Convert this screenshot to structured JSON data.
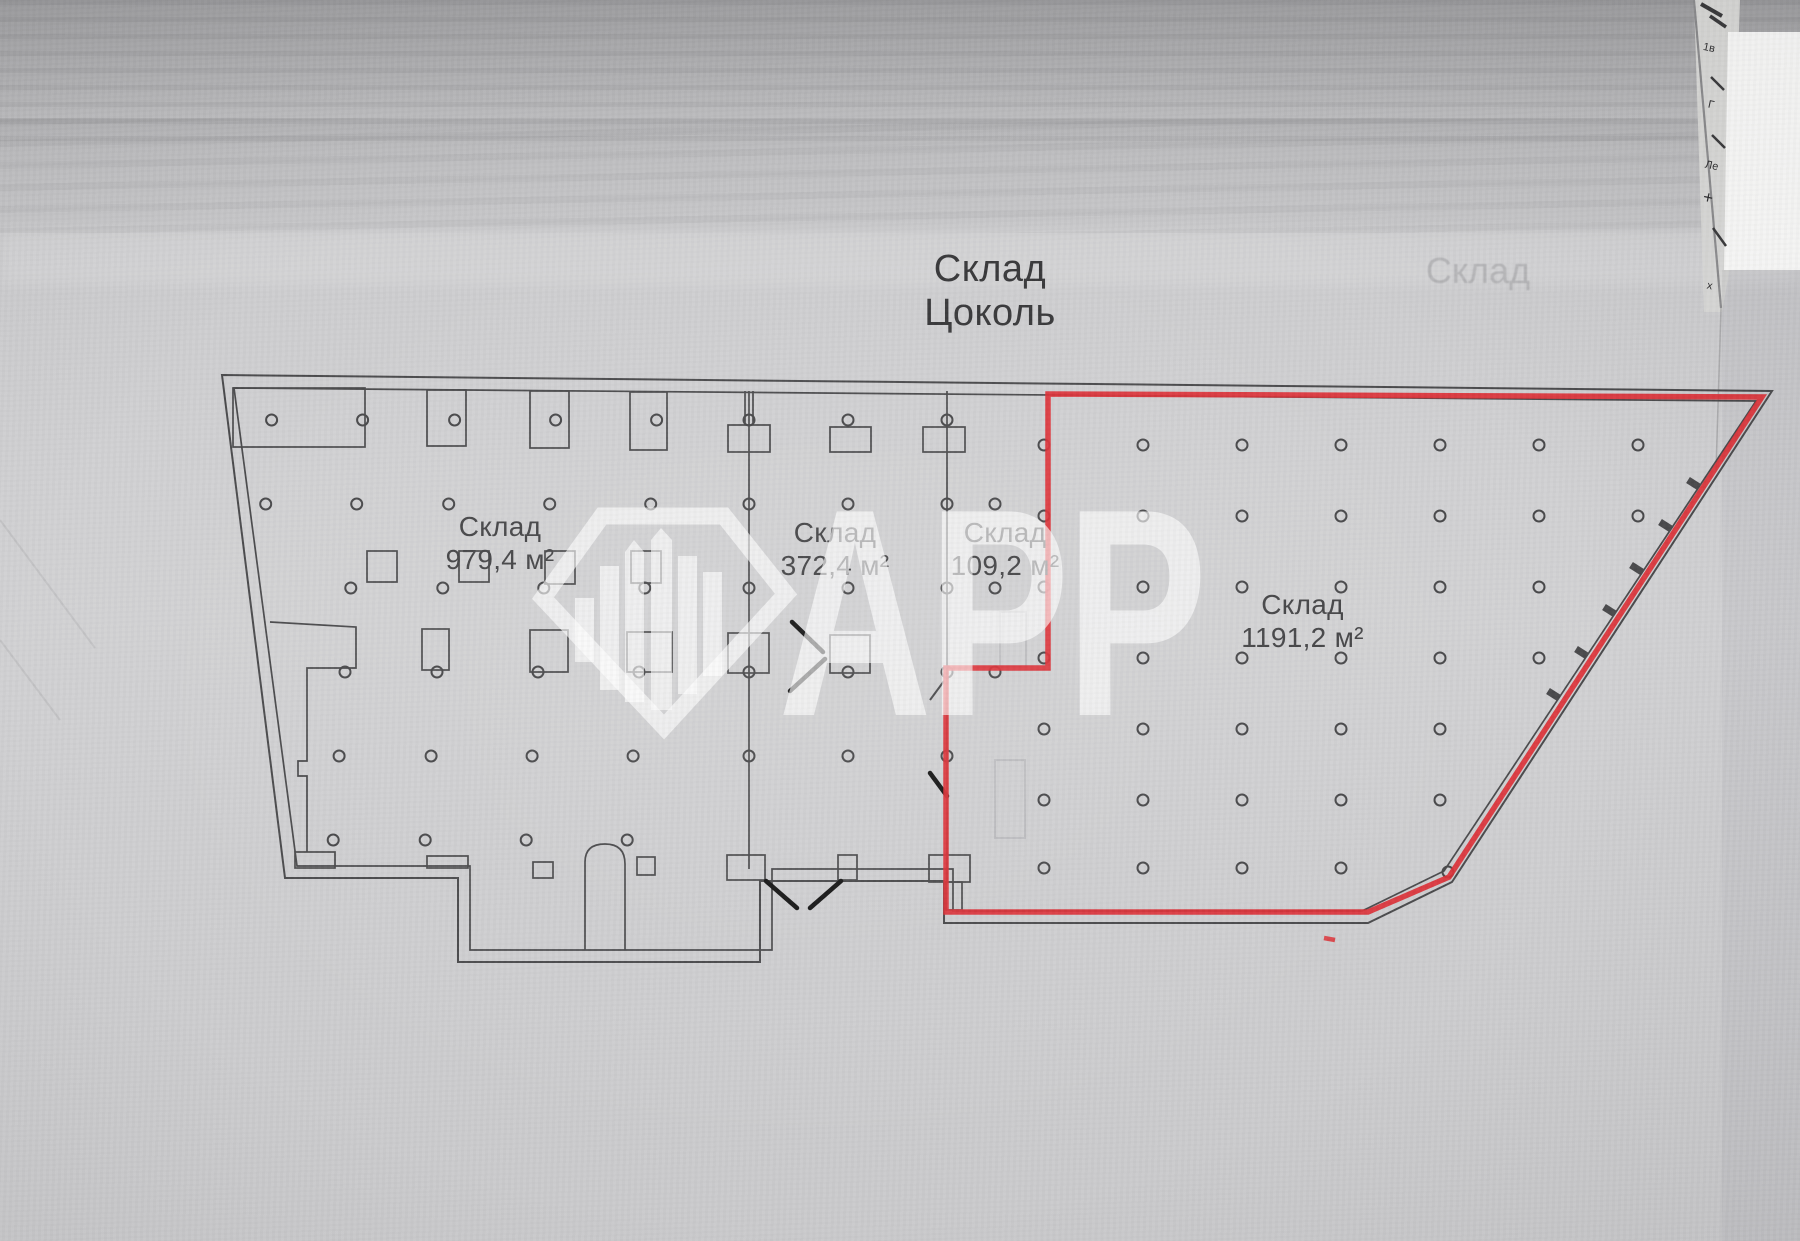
{
  "title": {
    "line1": "Склад",
    "line2": "Цоколь"
  },
  "rooms": [
    {
      "name": "Склад",
      "area": "979,4 м²"
    },
    {
      "name": "Склад",
      "area": "372,4 м²"
    },
    {
      "name": "Склад",
      "area": "109,2 м²"
    },
    {
      "name": "Склад",
      "area": "1191,2 м²"
    }
  ],
  "watermark": {
    "text": "АРР",
    "logo": "diamond-skyline-logo"
  },
  "ghost_text": "Склад",
  "edge_marks": [
    "1в",
    "Г",
    "Ле",
    "+",
    "х"
  ],
  "colors": {
    "highlight": "#dd3036",
    "plan_line": "#4a4a4c",
    "paper": "#cecED0"
  }
}
